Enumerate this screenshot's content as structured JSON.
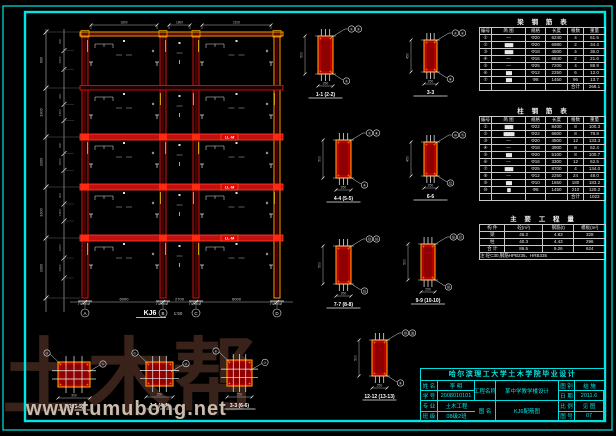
{
  "sheet": {
    "bg": "#000000",
    "border_color": "#00e6e6"
  },
  "watermark": {
    "big_text": "土木帮",
    "url": "www.tumubong.net",
    "big_color": "#38221a",
    "url_color": "#c9bcae"
  },
  "frame": {
    "name_label": "KJ6",
    "scale_label": "1:50",
    "columns_x": [
      85,
      163,
      196,
      277
    ],
    "left": 80,
    "right": 283,
    "top": 32,
    "floors_y": [
      35,
      88,
      137,
      187,
      238
    ],
    "base_y": 298,
    "beam_tags": [
      "LL-M",
      "LL-M",
      "LL-M"
    ],
    "axis_labels": [
      "A",
      "B",
      "C",
      "D"
    ],
    "bottom_dims": [
      "6000",
      "2700",
      "6000"
    ],
    "top_dims": [
      "1800",
      "1800",
      "2100"
    ],
    "left_dims": [
      "600",
      "3300",
      "3300",
      "3300",
      "3300",
      "4200"
    ],
    "sub_dims": [
      "900",
      "1500",
      "900",
      "1500",
      "900",
      "1500",
      "900",
      "1500",
      "1200",
      "1800",
      "1200"
    ]
  },
  "sections": {
    "vertical": [
      {
        "x": 318,
        "y": 36,
        "w": 15,
        "h": 38,
        "label": "1-1 (2-2)",
        "dw": "250",
        "dh": "500",
        "tags": [
          "①",
          "②",
          "③"
        ]
      },
      {
        "x": 424,
        "y": 40,
        "w": 13,
        "h": 32,
        "label": "3-3",
        "dw": "250",
        "dh": "450",
        "tags": [
          "④",
          "⑤",
          "⑥"
        ]
      },
      {
        "x": 336,
        "y": 140,
        "w": 15,
        "h": 38,
        "label": "4-4 (5-5)",
        "dw": "250",
        "dh": "500",
        "tags": [
          "⑦",
          "⑧",
          "⑨"
        ]
      },
      {
        "x": 424,
        "y": 142,
        "w": 13,
        "h": 34,
        "label": "6-6",
        "dw": "250",
        "dh": "450",
        "tags": [
          "⑩",
          "⑪",
          "⑫"
        ]
      },
      {
        "x": 336,
        "y": 246,
        "w": 15,
        "h": 38,
        "label": "7-7 (8-8)",
        "dw": "250",
        "dh": "500",
        "tags": [
          "⑬",
          "⑭",
          "⑮"
        ]
      },
      {
        "x": 421,
        "y": 244,
        "w": 14,
        "h": 36,
        "label": "9-9 (10-10)",
        "dw": "250",
        "dh": "500",
        "tags": [
          "⑯",
          "⑰",
          "⑱"
        ]
      },
      {
        "x": 372,
        "y": 340,
        "w": 15,
        "h": 36,
        "label": "12-12 (13-13)",
        "dw": "250",
        "dh": "500",
        "tags": [
          "⑲",
          "⑳",
          "②"
        ]
      }
    ],
    "square": [
      {
        "x": 58,
        "y": 362,
        "w": 32,
        "h": 25,
        "label": "2-2 (5-5)",
        "dw": "300",
        "tags": [
          "④",
          "⑤"
        ]
      },
      {
        "x": 146,
        "y": 362,
        "w": 27,
        "h": 24,
        "label": "1-1 (4-4)",
        "dw": "250",
        "tags": [
          "①",
          "②"
        ]
      },
      {
        "x": 227,
        "y": 360,
        "w": 25,
        "h": 26,
        "label": "3-3 (6-6)",
        "dw": "250",
        "tags": [
          "⑥",
          "⑦"
        ]
      }
    ]
  },
  "tables": {
    "t1": {
      "title": "梁 钢 筋 表",
      "head": [
        "编号",
        "简  图",
        "规格",
        "长度",
        "根数",
        "重量"
      ],
      "rows": [
        [
          "①",
          "—",
          "Φ20",
          "6240",
          "4",
          "61.5"
        ],
        [
          "②",
          "!▆▆▆",
          "Φ20",
          "6980",
          "2",
          "34.4"
        ],
        [
          "③",
          "!▆▆▆",
          "Φ18",
          "4500",
          "4",
          "36.0"
        ],
        [
          "④",
          "—",
          "Φ16",
          "6840",
          "2",
          "21.6"
        ],
        [
          "⑤",
          "—",
          "Φ25",
          "7200",
          "4",
          "88.9"
        ],
        [
          "⑥",
          "!▆▆",
          "Φ12",
          "2250",
          "6",
          "12.0"
        ],
        [
          "⑦",
          "!▆▆",
          "Φ8",
          "1450",
          "96",
          "13.7"
        ],
        [
          "",
          "",
          "",
          "",
          "合计",
          "268.1"
        ]
      ]
    },
    "t2": {
      "title": "柱 钢 筋 表",
      "head": [
        "编号",
        "简  图",
        "规格",
        "长度",
        "根数",
        "重量"
      ],
      "rows": [
        [
          "①",
          "!▆▆▆",
          "Φ22",
          "8400",
          "8",
          "100.3"
        ],
        [
          "②",
          "!▆▆▆▆",
          "Φ22",
          "6600",
          "8",
          "78.8"
        ],
        [
          "③",
          "—",
          "Φ20",
          "4500",
          "12",
          "133.3"
        ],
        [
          "④",
          "—",
          "Φ18",
          "3900",
          "8",
          "62.4"
        ],
        [
          "⑤",
          "!▆▆",
          "Φ20",
          "5100",
          "8",
          "100.7"
        ],
        [
          "⑥",
          "—",
          "Φ16",
          "3300",
          "12",
          "62.5"
        ],
        [
          "⑦",
          "!▆▆▆",
          "Φ25",
          "8700",
          "4",
          "134.0"
        ],
        [
          "⑧",
          "—",
          "Φ12",
          "2250",
          "24",
          "48.0"
        ],
        [
          "⑨",
          "!▆▆",
          "Φ10",
          "1650",
          "180",
          "183.2"
        ],
        [
          "⑩",
          "!▆",
          "Φ8",
          "1450",
          "210",
          "120.2"
        ],
        [
          "",
          "",
          "",
          "",
          "合计",
          "1023"
        ]
      ]
    },
    "t3": {
      "title": "主 要 工 程 量",
      "head": [
        "构 件",
        "砼(m³)",
        "钢筋(t)",
        "模板(m²)"
      ],
      "rows": [
        [
          "梁",
          "46.2",
          "4.83",
          "328"
        ],
        [
          "柱",
          "40.3",
          "4.43",
          "296"
        ],
        [
          "合 计",
          "86.5",
          "9.26",
          "624"
        ]
      ],
      "note": "注:砼C30,钢筋HPB235、HRB335"
    }
  },
  "titleblock": {
    "school_title": "哈尔滨理工大学土木学院毕业设计",
    "left": [
      [
        "姓 名",
        "李 明"
      ],
      [
        "学 号",
        "2008010101"
      ],
      [
        "专 业",
        "土木工程"
      ],
      [
        "班 级",
        "08级2班"
      ]
    ],
    "mid": [
      [
        "工程名称",
        "某中学教学楼设计"
      ],
      [
        "图  名",
        "KJ6配筋图"
      ]
    ],
    "right": [
      [
        "图 别",
        "结 施"
      ],
      [
        "日 期",
        "2011.6"
      ],
      [
        "比 例",
        "见 图"
      ],
      [
        "图 号",
        "07"
      ]
    ]
  }
}
